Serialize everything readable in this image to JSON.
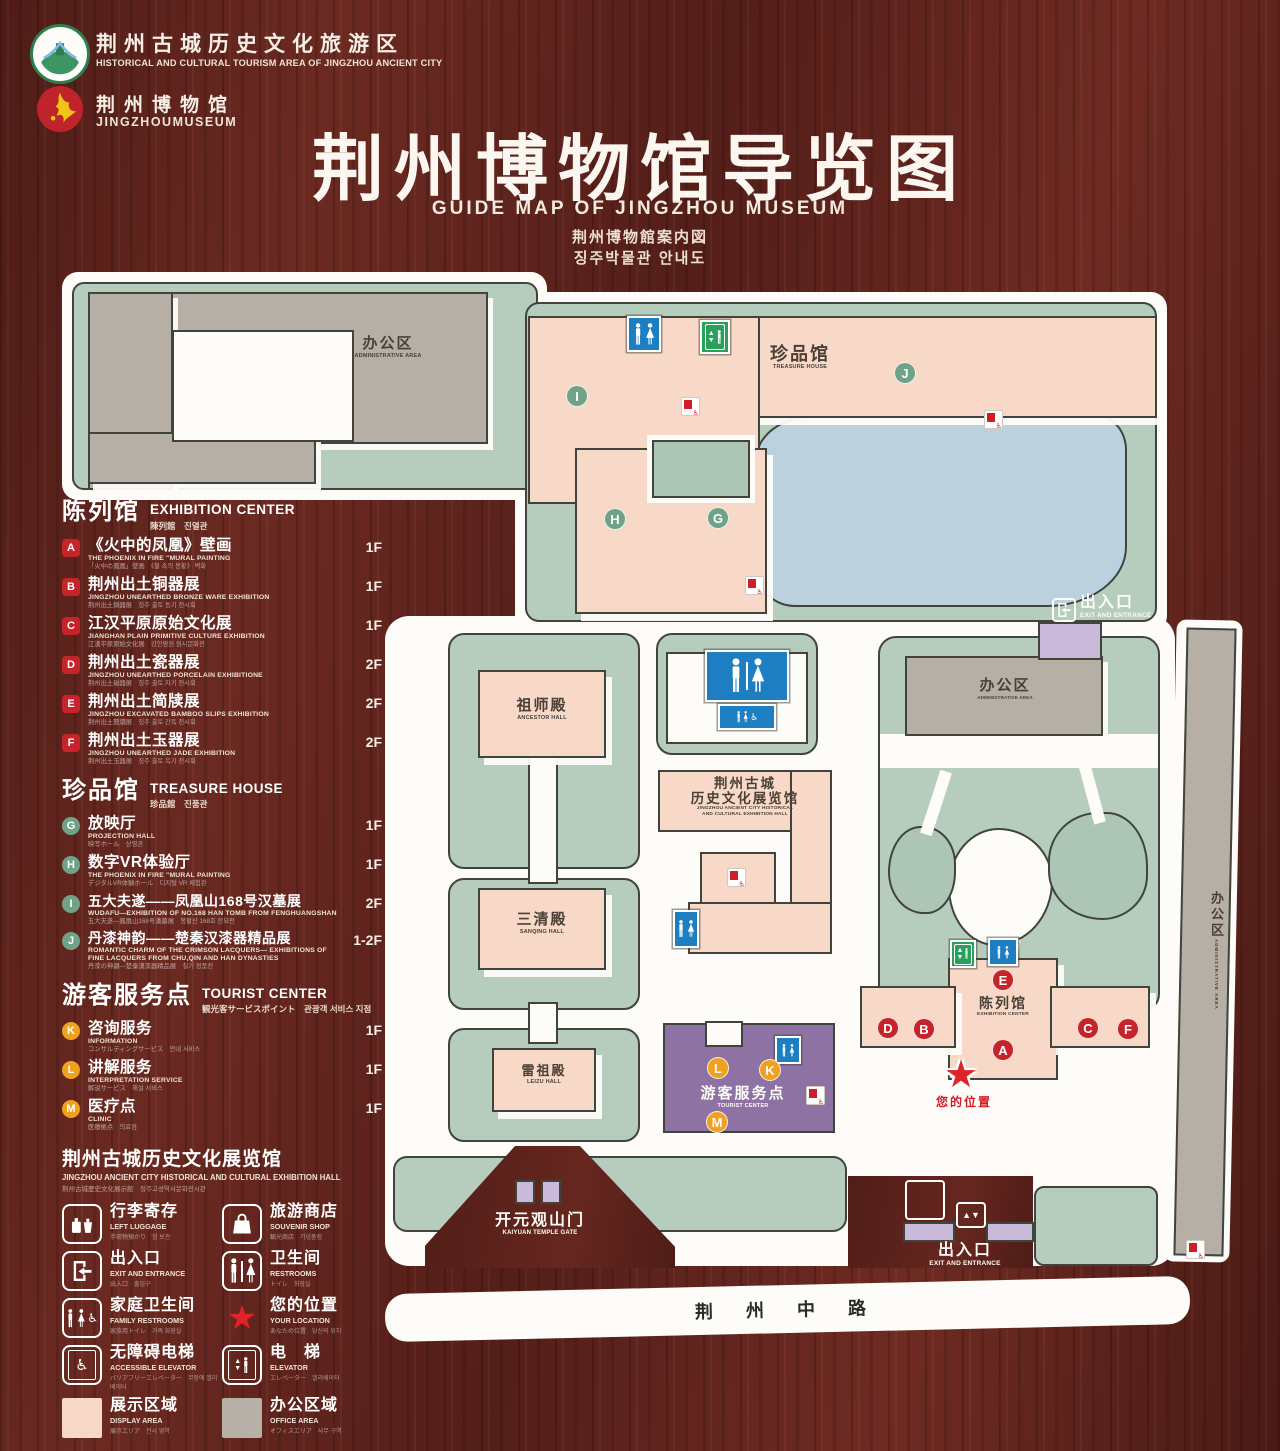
{
  "header": {
    "logo_tourism": {
      "zh": "荆州古城历史文化旅游区",
      "en": "HISTORICAL AND CULTURAL TOURISM AREA OF JINGZHOU ANCIENT CITY"
    },
    "logo_museum": {
      "zh": "荆州博物馆",
      "en": "JINGZHOUMUSEUM"
    },
    "title": "荆州博物馆导览图",
    "subtitle_en": "GUIDE MAP OF JINGZHOU MUSEUM",
    "subtitle_ja": "荆州博物館案内図",
    "subtitle_ko": "징주박물관 안내도"
  },
  "sidebar": {
    "sections": [
      {
        "zh": "陈列馆",
        "en": "EXHIBITION CENTER",
        "sub": "陳列館　진열관",
        "items": [
          {
            "key": "A",
            "zh": "《火中的凤凰》壁画",
            "en": "THE PHOENIX IN FIRE \"MURAL PAINTING",
            "sub": "「火中の鳳凰」壁画　《불 속의 봉황》 벽화",
            "floor": "1F"
          },
          {
            "key": "B",
            "zh": "荆州出土铜器展",
            "en": "JINGZHOU UNEARTHED BRONZE WARE EXHIBITION",
            "sub": "荆州出土銅器展　징주 출토 동기 전시회",
            "floor": "1F"
          },
          {
            "key": "C",
            "zh": "江汉平原原始文化展",
            "en": "JIANGHAN PLAIN PRIMITIVE CULTURE EXHIBITION",
            "sub": "江漢平原原始文化展　강한평원 원시문화전",
            "floor": "1F"
          },
          {
            "key": "D",
            "zh": "荆州出土瓷器展",
            "en": "JINGZHOU UNEARTHED PORCELAIN EXHIBITIONE",
            "sub": "荆州出土磁器展　징주 출토 자기 전시회",
            "floor": "2F"
          },
          {
            "key": "E",
            "zh": "荆州出土简牍展",
            "en": "JINGZHOU EXCAVATED BAMBOO SLIPS EXHIBITION",
            "sub": "荆州出土簡牘展　징주 출토 간독 전시회",
            "floor": "2F"
          },
          {
            "key": "F",
            "zh": "荆州出土玉器展",
            "en": "JINGZHOU UNEARTHED JADE EXHIBITION",
            "sub": "荆州出土玉器展　징주 출토 옥기 전시회",
            "floor": "2F"
          }
        ]
      },
      {
        "zh": "珍品馆",
        "en": "TREASURE HOUSE",
        "sub": "珍品館　진품관",
        "items": [
          {
            "key": "G",
            "zh": "放映厅",
            "en": "PROJECTION HALL",
            "sub": "映写ホール　상영관",
            "floor": "1F"
          },
          {
            "key": "H",
            "zh": "数字VR体验厅",
            "en": "THE PHOENIX IN FIRE \"MURAL PAINTING",
            "sub": "デジタルVR体験ホール　디지털 VR 체험관",
            "floor": "1F"
          },
          {
            "key": "I",
            "zh": "五大夫遂——凤凰山168号汉墓展",
            "en": "WUDAFU—EXHIBITION OF NO.168 HAN TOMB FROM FENGHUANGSHAN",
            "sub": "五大夫遂—鳳凰山168号漢墓展　봉황산 168호 한묘전",
            "floor": "2F"
          },
          {
            "key": "J",
            "zh": "丹漆神韵——楚秦汉漆器精品展",
            "en": "ROMANTIC CHARM OF THE CRIMSON LACQUERS— EXHIBITIONS OF FINE LACQUERS FROM CHU,QIN AND HAN DYNASTIES",
            "sub": "丹漆の神韻—楚秦漢漆器精品展　칠기 정품전",
            "floor": "1-2F"
          }
        ]
      },
      {
        "zh": "游客服务点",
        "en": "TOURIST CENTER",
        "sub": "観光客サービスポイント　관광객 서비스 지점",
        "items": [
          {
            "key": "K",
            "zh": "咨询服务",
            "en": "INFORMATION",
            "sub": "コンサルティングサービス　안내 서비스",
            "floor": "1F"
          },
          {
            "key": "L",
            "zh": "讲解服务",
            "en": "INTERPRETATION SERVICE",
            "sub": "解説サービス　해설 서비스",
            "floor": "1F"
          },
          {
            "key": "M",
            "zh": "医疗点",
            "en": "CLINIC",
            "sub": "医療拠点　의료점",
            "floor": "1F"
          }
        ]
      }
    ],
    "hall": {
      "zh": "荆州古城历史文化展览馆",
      "en": "JINGZHOU ANCIENT CITY HISTORICAL AND CULTURAL EXHIBITION HALL",
      "sub": "荆州古城歴史文化展示館　징주고성역사문화전시관"
    },
    "icon_legend": [
      {
        "icon": "left-luggage",
        "zh": "行李寄存",
        "en": "LEFT LUGGAGE",
        "sub": "手荷物預かり　짐 보관"
      },
      {
        "icon": "souvenir-shop",
        "zh": "旅游商店",
        "en": "SOUVENIR SHOP",
        "sub": "観光商店　기념품점"
      },
      {
        "icon": "exit-entrance",
        "zh": "出入口",
        "en": "EXIT AND ENTRANCE",
        "sub": "出入口　출입구"
      },
      {
        "icon": "restrooms",
        "zh": "卫生间",
        "en": "RESTROOMS",
        "sub": "トイレ　화장실"
      },
      {
        "icon": "family-restrooms",
        "zh": "家庭卫生间",
        "en": "FAMILY RESTROOMS",
        "sub": "家族用トイレ　가족 화장실"
      },
      {
        "icon": "your-location",
        "zh": "您的位置",
        "en": "YOUR LOCATION",
        "sub": "あなたの位置　당신의 위치"
      },
      {
        "icon": "accessible-elevator",
        "zh": "无障碍电梯",
        "en": "ACCESSIBLE ELEVATOR",
        "sub": "バリアフリーエレベーター　무장애 엘리베이터"
      },
      {
        "icon": "elevator",
        "zh": "电　梯",
        "en": "ELEVATOR",
        "sub": "エレベーター　엘리베이터"
      }
    ],
    "areas": [
      {
        "icon": "display-area",
        "zh": "展示区域",
        "en": "DISPLAY AREA",
        "sub": "展示エリア　전시 영역",
        "color": "#f7d8c6"
      },
      {
        "icon": "office-area",
        "zh": "办公区域",
        "en": "OFFICE AREA",
        "sub": "オフィスエリア　사무 구역",
        "color": "#b6b0a6"
      }
    ]
  },
  "map": {
    "road": "荆 州 中 路",
    "gate": {
      "zh": "开元观山门",
      "en": "KAIYUAN TEMPLE GATE"
    },
    "exit": {
      "zh": "出入口",
      "en": "EXIT AND ENTRANCE"
    },
    "admin": {
      "zh": "办公区",
      "en": "ADMINISTRATIVE AREA"
    },
    "treasure": {
      "zh": "珍品馆",
      "en": "TREASURE HOUSE"
    },
    "ancestor": {
      "zh": "祖师殿",
      "en": "ANCESTOR HALL"
    },
    "sanqing": {
      "zh": "三清殿",
      "en": "SANQING HALL"
    },
    "leizu": {
      "zh": "雷祖殿",
      "en": "LEIZU HALL"
    },
    "hist": {
      "zh1": "荆州古城",
      "zh2": "历史文化展览馆",
      "en1": "JINGZHOU ANCIENT CITY HISTORICAL",
      "en2": "AND CULTURAL EXHIBITION HALL"
    },
    "tourist": {
      "zh": "游客服务点",
      "en": "TOURIST CENTER"
    },
    "exhibition": {
      "zh": "陈列馆",
      "en": "EXHIBITION CENTER"
    },
    "location": {
      "zh": "您的位置"
    },
    "markers": {
      "A": "A",
      "B": "B",
      "C": "C",
      "D": "D",
      "E": "E",
      "F": "F",
      "G": "G",
      "H": "H",
      "I": "I",
      "J": "J",
      "K": "K",
      "L": "L",
      "M": "M"
    }
  },
  "colors": {
    "badge_red": "#c5242b",
    "badge_green": "#6fa287",
    "badge_yellow": "#f0a11f",
    "sign_blue": "#1d7fc1",
    "sign_green": "#2aa15b",
    "lake_blue": "#bbd1de",
    "tourist_purple": "#8e72a4",
    "display_area": "#f7d8c6",
    "office_area": "#b6b0a6"
  }
}
